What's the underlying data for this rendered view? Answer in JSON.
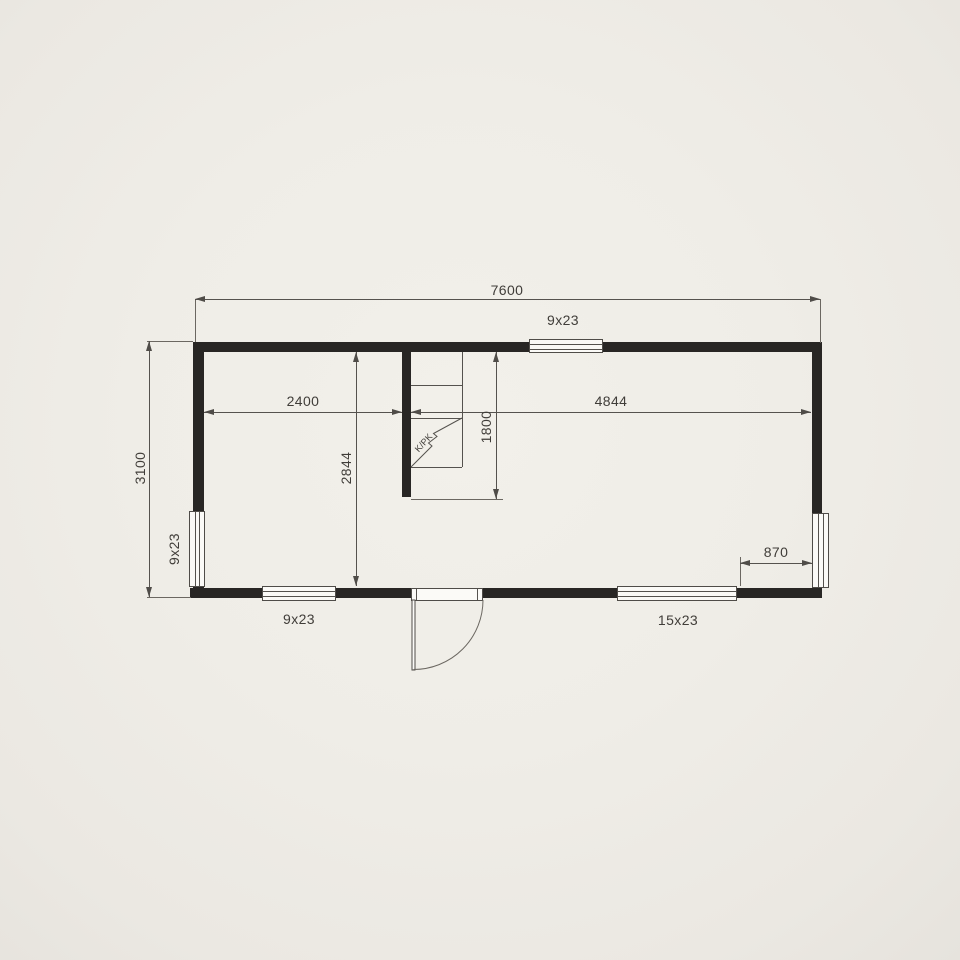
{
  "drawing": {
    "type": "floor-plan",
    "dimensions": {
      "overall_width": "7600",
      "overall_depth": "3100",
      "left_room_width": "2400",
      "room_depth": "2844",
      "main_room_width": "4844",
      "kitchen_recess_depth": "1800",
      "right_opening_offset": "870"
    },
    "openings": {
      "window_top": "9x23",
      "window_left": "9x23",
      "window_bottom_left": "9x23",
      "window_bottom_right": "15x23"
    },
    "fixtures": {
      "kitchenette": "K/PK"
    },
    "colors": {
      "background": "#efede7",
      "wall": "#282624",
      "line": "#4f4c48",
      "text": "#403d39",
      "window_fill": "#fbfaf7"
    }
  }
}
